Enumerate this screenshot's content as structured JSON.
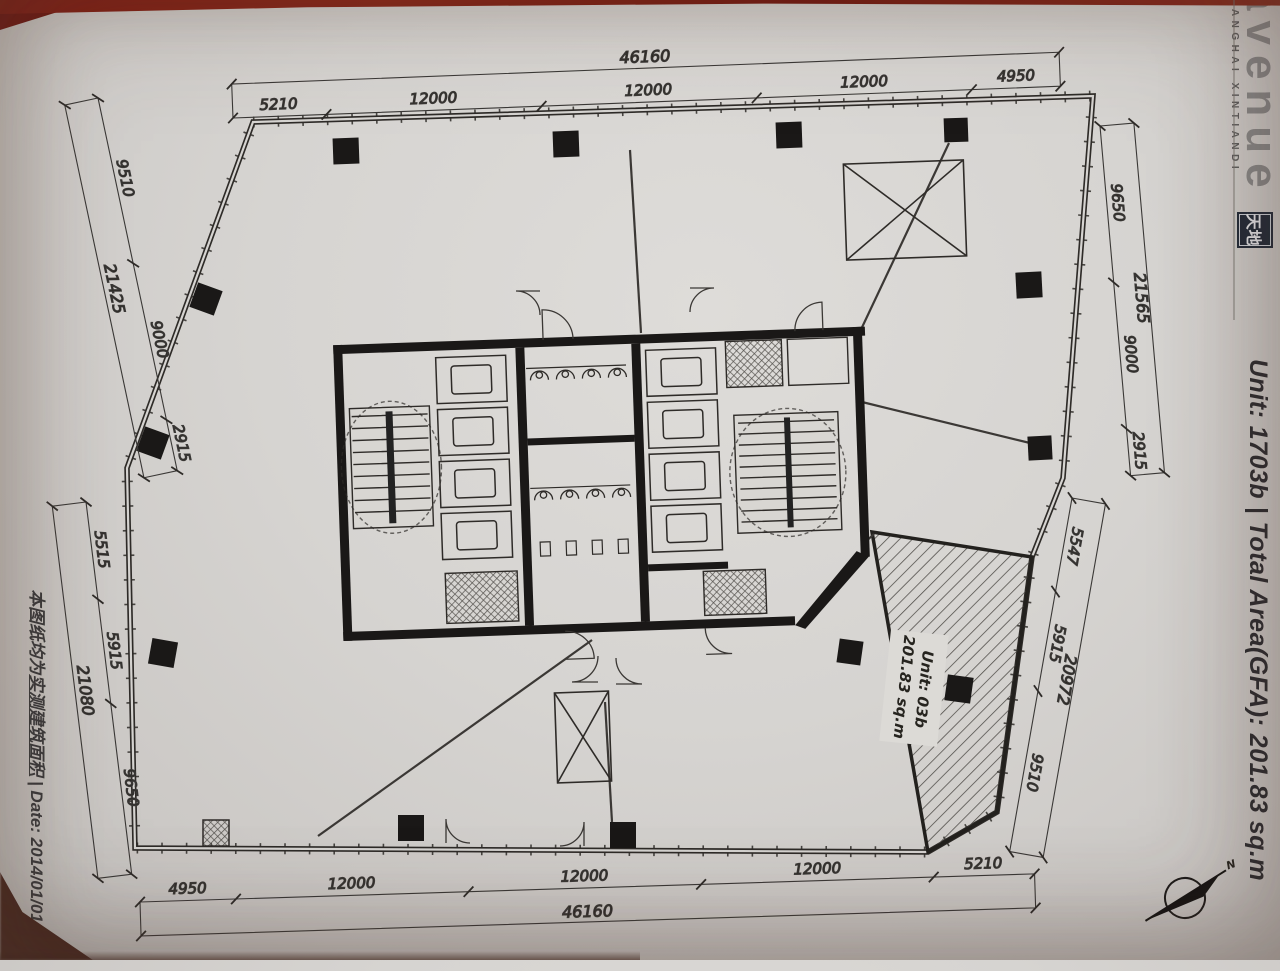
{
  "branding": {
    "logo_text": "avenue",
    "logo_sub": "SHANGHAI XINTIANDI",
    "logo_seal": "天地"
  },
  "captions": {
    "right": "Unit: 1703b | Total Area(GFA): 201.83 sq.m",
    "left_prefix": "本图纸均为",
    "left_underlined": "实测建筑面积",
    "left_suffix": " | Date: 2014/01/01"
  },
  "unit_label": {
    "line1": "Unit: 03b",
    "line2": "201.83 sq.m"
  },
  "north": {
    "label": "N"
  },
  "dims": {
    "top": {
      "total": "46160",
      "segments": [
        "5210",
        "12000",
        "12000",
        "12000",
        "4950"
      ]
    },
    "bottom": {
      "total": "46160",
      "segments": [
        "4950",
        "12000",
        "12000",
        "12000",
        "5210"
      ]
    },
    "left_upper": {
      "total": "21425",
      "segments": [
        "9510",
        "9000",
        "2915"
      ]
    },
    "left_lower": {
      "total": "21080",
      "segments": [
        "5515",
        "5915",
        "9650"
      ]
    },
    "right_upper": {
      "total": "21565",
      "segments": [
        "9650",
        "9000",
        "2915"
      ]
    },
    "right_lower": {
      "total": "20972",
      "segments": [
        "5547",
        "5915",
        "9510"
      ]
    }
  },
  "colors": {
    "paper": "#d6d4d1",
    "ink": "#2e2b28",
    "table_red": "#7e1b12",
    "seal_navy": "#202a38"
  }
}
